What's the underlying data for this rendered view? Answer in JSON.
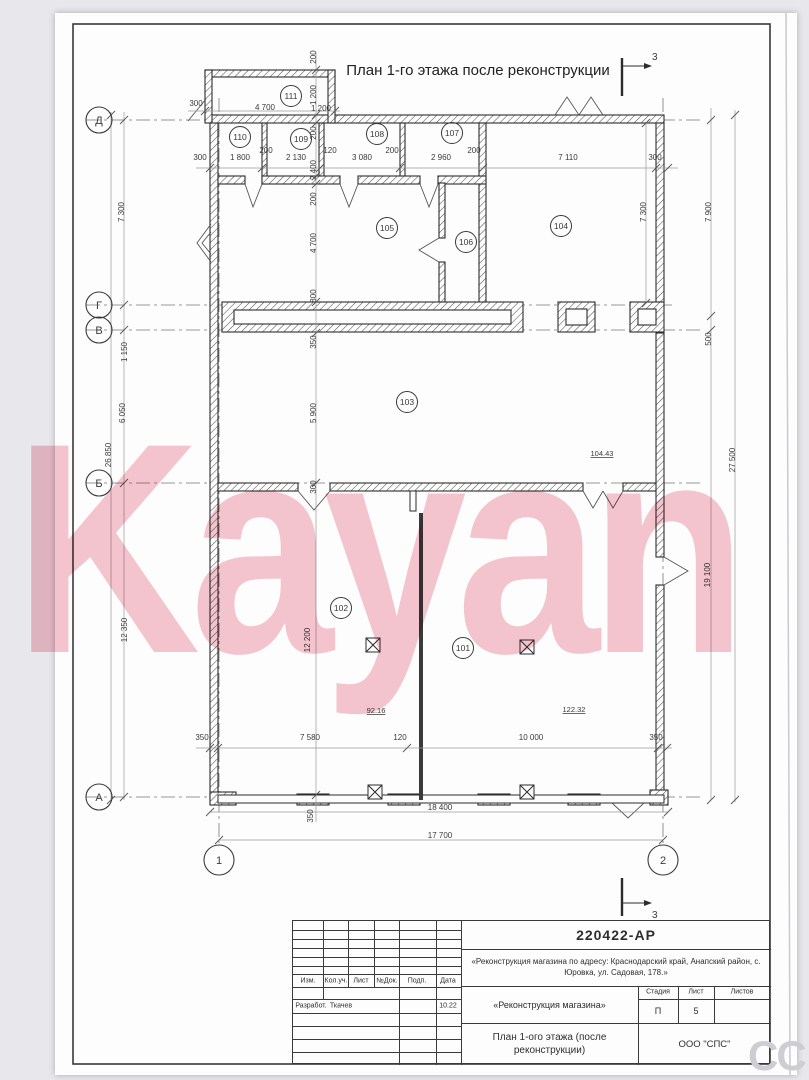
{
  "sheet": {
    "title": "План 1-го этажа после реконструкции",
    "section_mark": "3",
    "watermark": "Kayan",
    "corner_watermark": "СС"
  },
  "plan": {
    "axis_rows": [
      {
        "label": "Д",
        "y": 120
      },
      {
        "label": "Г",
        "y": 305
      },
      {
        "label": "В",
        "y": 330
      },
      {
        "label": "Б",
        "y": 483
      },
      {
        "label": "А",
        "y": 797
      }
    ],
    "axis_cols": [
      {
        "label": "1",
        "x": 219
      },
      {
        "label": "2",
        "x": 663
      }
    ],
    "rooms": [
      {
        "n": "111",
        "x": 291,
        "y": 96
      },
      {
        "n": "110",
        "x": 240,
        "y": 137
      },
      {
        "n": "109",
        "x": 301,
        "y": 139
      },
      {
        "n": "108",
        "x": 377,
        "y": 134
      },
      {
        "n": "107",
        "x": 452,
        "y": 133
      },
      {
        "n": "105",
        "x": 387,
        "y": 228
      },
      {
        "n": "106",
        "x": 466,
        "y": 242
      },
      {
        "n": "104",
        "x": 561,
        "y": 226
      },
      {
        "n": "103",
        "x": 407,
        "y": 402
      },
      {
        "n": "102",
        "x": 341,
        "y": 608
      },
      {
        "n": "101",
        "x": 463,
        "y": 648
      }
    ],
    "areas": [
      {
        "v": "104.43",
        "x": 602,
        "y": 456
      },
      {
        "v": "92.16",
        "x": 376,
        "y": 713
      },
      {
        "v": "122.32",
        "x": 574,
        "y": 712
      }
    ],
    "dims": [
      {
        "t": "300",
        "x": 200,
        "y": 160
      },
      {
        "t": "1 800",
        "x": 240,
        "y": 160
      },
      {
        "t": "200",
        "x": 266,
        "y": 153
      },
      {
        "t": "2 130",
        "x": 296,
        "y": 160
      },
      {
        "t": "120",
        "x": 330,
        "y": 153
      },
      {
        "t": "3 080",
        "x": 362,
        "y": 160
      },
      {
        "t": "200",
        "x": 392,
        "y": 153
      },
      {
        "t": "2 960",
        "x": 441,
        "y": 160
      },
      {
        "t": "200",
        "x": 474,
        "y": 153
      },
      {
        "t": "7 110",
        "x": 568,
        "y": 160
      },
      {
        "t": "300",
        "x": 655,
        "y": 160
      },
      {
        "t": "300",
        "x": 196,
        "y": 106
      },
      {
        "t": "4 700",
        "x": 265,
        "y": 110
      },
      {
        "t": "1 200",
        "x": 321,
        "y": 111
      },
      {
        "t": "200",
        "x": 316,
        "y": 57,
        "r": -90
      },
      {
        "t": "1 200",
        "x": 316,
        "y": 95,
        "r": -90
      },
      {
        "t": "200",
        "x": 316,
        "y": 133,
        "r": -90
      },
      {
        "t": "2 400",
        "x": 316,
        "y": 170,
        "r": -90
      },
      {
        "t": "200",
        "x": 316,
        "y": 199,
        "r": -90
      },
      {
        "t": "4 700",
        "x": 316,
        "y": 243,
        "r": -90
      },
      {
        "t": "800",
        "x": 316,
        "y": 296,
        "r": -90
      },
      {
        "t": "350",
        "x": 316,
        "y": 342,
        "r": -90
      },
      {
        "t": "5 900",
        "x": 316,
        "y": 413,
        "r": -90
      },
      {
        "t": "300",
        "x": 316,
        "y": 487,
        "r": -90
      },
      {
        "t": "12 200",
        "x": 310,
        "y": 640,
        "r": -90
      },
      {
        "t": "350",
        "x": 313,
        "y": 816,
        "r": -90
      },
      {
        "t": "7 300",
        "x": 124,
        "y": 212,
        "r": -90
      },
      {
        "t": "1 150",
        "x": 127,
        "y": 352,
        "r": -90
      },
      {
        "t": "6 050",
        "x": 125,
        "y": 413,
        "r": -90
      },
      {
        "t": "12 350",
        "x": 127,
        "y": 630,
        "r": -90
      },
      {
        "t": "26 850",
        "x": 111,
        "y": 455,
        "r": -90
      },
      {
        "t": "7 300",
        "x": 646,
        "y": 212,
        "r": -90
      },
      {
        "t": "7 900",
        "x": 711,
        "y": 212,
        "r": -90
      },
      {
        "t": "500",
        "x": 711,
        "y": 339,
        "r": -90
      },
      {
        "t": "19 100",
        "x": 710,
        "y": 575,
        "r": -90
      },
      {
        "t": "27 500",
        "x": 735,
        "y": 460,
        "r": -90
      },
      {
        "t": "350",
        "x": 202,
        "y": 740
      },
      {
        "t": "7 580",
        "x": 310,
        "y": 740
      },
      {
        "t": "120",
        "x": 400,
        "y": 740
      },
      {
        "t": "10 000",
        "x": 531,
        "y": 740
      },
      {
        "t": "350",
        "x": 656,
        "y": 740
      },
      {
        "t": "18 400",
        "x": 440,
        "y": 810
      },
      {
        "t": "17 700",
        "x": 440,
        "y": 838
      }
    ]
  },
  "titleblock": {
    "doc_number": "220422-АР",
    "address": "«Реконструкция магазина по адресу: Краснодарский край, Анапский район, с. Юровка, ул. Садовая, 178.»",
    "cols": [
      "Изм.",
      "Кол.уч.",
      "Лист",
      "№Док.",
      "Подп.",
      "Дата"
    ],
    "developed_label": "Разработ.",
    "developer": "Ткачев",
    "date": "10.22",
    "project": "«Реконструкция магазина»",
    "stage_label": "Стадия",
    "sheet_label": "Лист",
    "sheets_label": "Листов",
    "stage": "П",
    "sheet_no": "5",
    "sheets_total": "",
    "sheet_name": "План 1-ого этажа (после реконструкции)",
    "company": "ООО \"СПС\""
  }
}
